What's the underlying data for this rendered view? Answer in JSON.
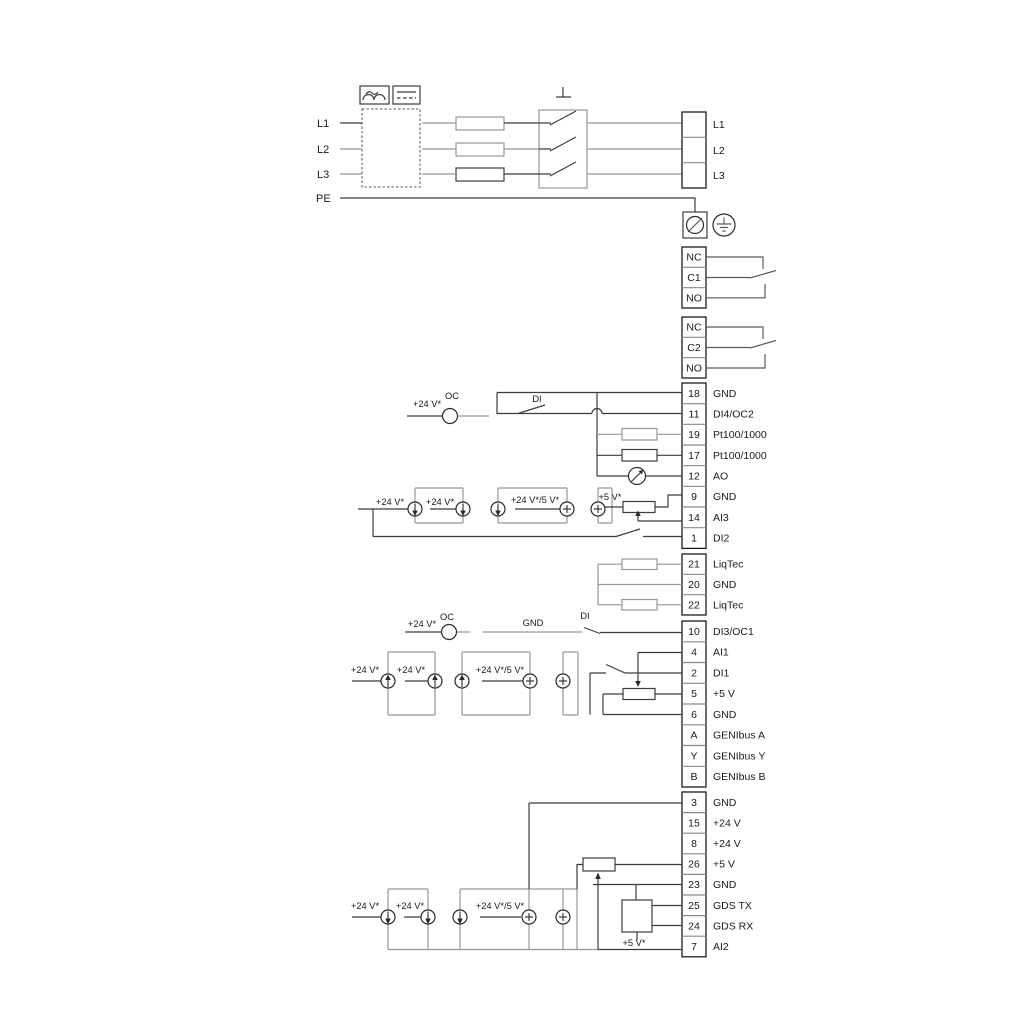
{
  "power": {
    "inputs": [
      "L1",
      "L2",
      "L3",
      "PE"
    ],
    "outputs": [
      "L1",
      "L2",
      "L3"
    ]
  },
  "relay1": [
    "NC",
    "C1",
    "NO"
  ],
  "relay2": [
    "NC",
    "C2",
    "NO"
  ],
  "tg1": [
    {
      "n": "18",
      "l": "GND"
    },
    {
      "n": "11",
      "l": "DI4/OC2"
    },
    {
      "n": "19",
      "l": "Pt100/1000"
    },
    {
      "n": "17",
      "l": "Pt100/1000"
    },
    {
      "n": "12",
      "l": "AO"
    },
    {
      "n": "9",
      "l": "GND"
    },
    {
      "n": "14",
      "l": "AI3"
    },
    {
      "n": "1",
      "l": "DI2"
    }
  ],
  "tg2": [
    {
      "n": "21",
      "l": "LiqTec"
    },
    {
      "n": "20",
      "l": "GND"
    },
    {
      "n": "22",
      "l": "LiqTec"
    }
  ],
  "tg3": [
    {
      "n": "10",
      "l": "DI3/OC1"
    },
    {
      "n": "4",
      "l": "AI1"
    },
    {
      "n": "2",
      "l": "DI1"
    },
    {
      "n": "5",
      "l": "+5 V"
    },
    {
      "n": "6",
      "l": "GND"
    },
    {
      "n": "A",
      "l": "GENIbus A"
    },
    {
      "n": "Y",
      "l": "GENIbus Y"
    },
    {
      "n": "B",
      "l": "GENIbus B"
    }
  ],
  "tg4": [
    {
      "n": "3",
      "l": "GND"
    },
    {
      "n": "15",
      "l": "+24 V"
    },
    {
      "n": "8",
      "l": "+24 V"
    },
    {
      "n": "26",
      "l": "+5 V"
    },
    {
      "n": "23",
      "l": "GND"
    },
    {
      "n": "25",
      "l": "GDS TX"
    },
    {
      "n": "24",
      "l": "GDS RX"
    },
    {
      "n": "7",
      "l": "AI2"
    }
  ],
  "ann": {
    "v24": "+24 V*",
    "v245": "+24 V*/5 V*",
    "v5": "+5 V*",
    "oc": "OC",
    "di": "DI",
    "gnd": "GND"
  },
  "colors": {
    "wire": "#3c3c3c",
    "gray": "#979797",
    "text": "#1a1a1a",
    "bg": "#ffffff"
  }
}
